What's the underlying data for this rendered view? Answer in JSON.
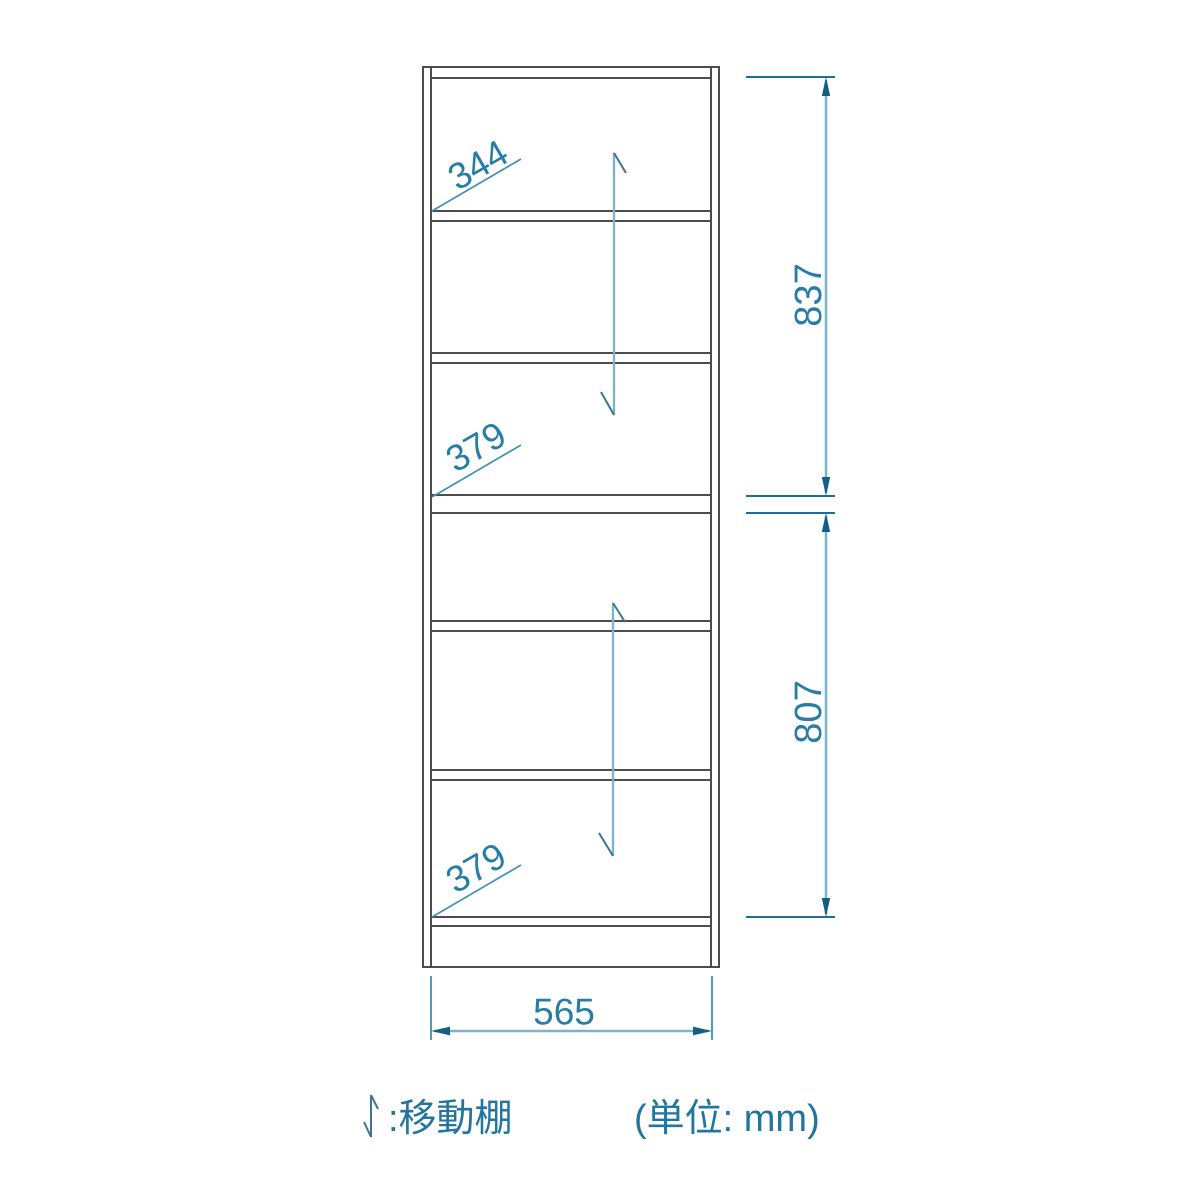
{
  "diagram": {
    "title": "bookshelf-dimension-drawing",
    "unit_note": "(単位: mm)",
    "legend_label": ":移動棚",
    "dims": {
      "inner_width": "565",
      "upper_section_height": "837",
      "lower_section_height": "807",
      "top_shelf_pitch": "344",
      "upper_shelf_pitch": "379",
      "lower_shelf_pitch": "379"
    },
    "colors": {
      "cabinet_outline": "#4d4d4d",
      "dimension_line": "#7ab5c9",
      "extension_line": "#1e6f94",
      "arrowhead": "#156080",
      "leader_line": "#4191b4",
      "label_text": "#277da6",
      "legend_text": "#2176a0",
      "background": "#ffffff"
    }
  }
}
